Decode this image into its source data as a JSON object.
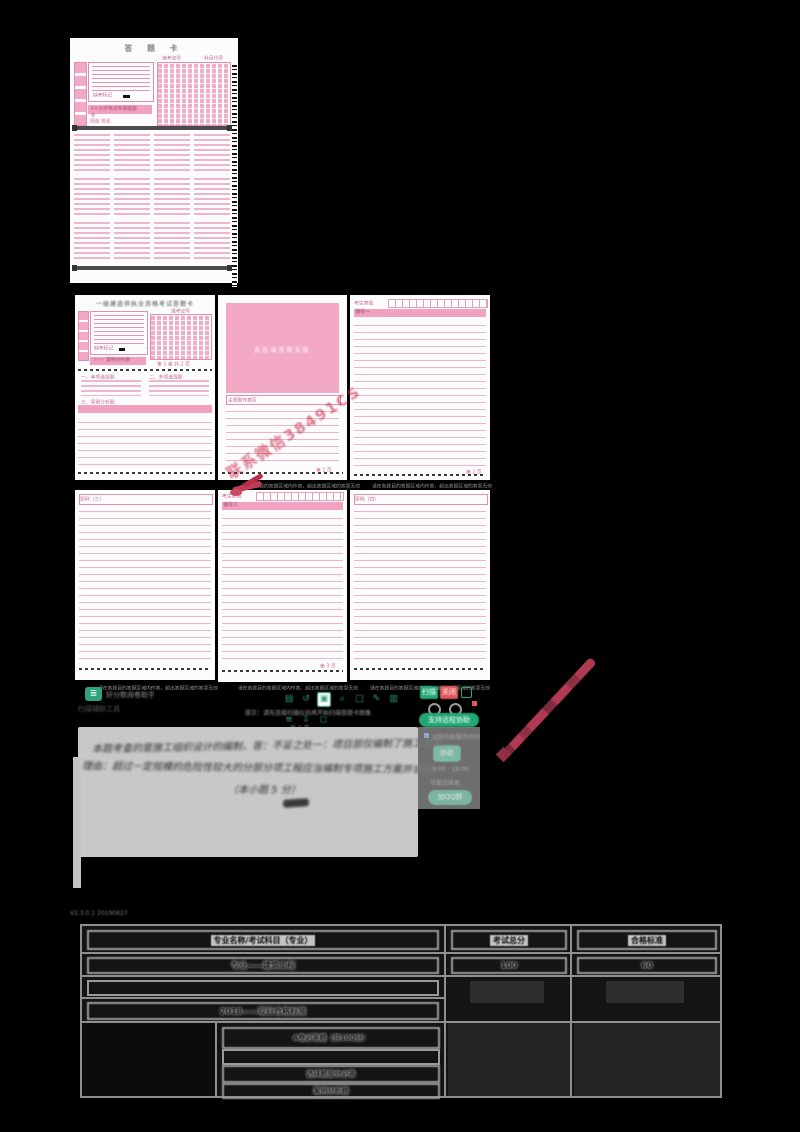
{
  "sheet1": {
    "title": "答  题  卡",
    "id_header": "准考证号",
    "subject_header": "科目代号",
    "absent_label": "缺考标记",
    "banner": "××大学考试专用答题卡",
    "class_row": "班级        姓名"
  },
  "sheet2": {
    "title": "一级建造师执业资格考试答题卡",
    "id_header": "准考证号",
    "vol_label": "第 1 卷  共 2 页",
    "sec1": "一、单项选择题",
    "sec2": "二、多项选择题",
    "sec3": "三、案例分析题",
    "banner": "（一）案例分析题",
    "absent_label": "缺考标记"
  },
  "pink_block_text": "此区域答题无效",
  "watermark_text": "联系微信38491CS",
  "panelB": {
    "header": "主观题作答区",
    "page": "第 1 页"
  },
  "panelC": {
    "header": "考生禁填",
    "band": "题号一",
    "page": "第 2 页"
  },
  "panelD": {
    "label": "案例（三）"
  },
  "panelE": {
    "header": "考生禁填",
    "band": "题号三",
    "page": "第 3 页"
  },
  "panelF": {
    "label": "案例（四）"
  },
  "tear_note": "请在各题目的答题区域内作答，超出答题区域的答案无效",
  "app": {
    "logo_glyph": "≣",
    "logo_text": "好分数阅卷助手",
    "sub_text": "扫描辅助工具",
    "tooltip": "提示：请先连接扫描仪后再开始扫描答题卡图像",
    "pages_text": "共 1 页",
    "toolbar_icons": [
      "▤",
      "↺",
      "▣",
      "⌕",
      "□",
      "✎",
      "▥",
      "≡",
      "⇩",
      "◻"
    ],
    "btn_scan": "扫描",
    "btn_stop": "关闭",
    "pill_remote": "支持远程协助",
    "btn_small": "协助",
    "note1": "远程协助服务时间",
    "note2": "9:00 - 18:00",
    "note3": "节假日休息",
    "pill_qq": "加QQ群",
    "status_text": "V2.3.0.1  20190627"
  },
  "handwriting": {
    "line1": "本题考查的是施工组织设计的编制，答：不妥之处一：项目部仅编制了施工方案；",
    "line2": "理由：超过一定规模的危险性较大的分部分项工程应当编制专项施工方案并论证。",
    "line3": "（本小题 5 分）"
  },
  "table": {
    "headers": [
      "专业名称/考试科目（专业）",
      "考试总分",
      "合格标准"
    ],
    "row1": {
      "c1": "专业——建筑工程",
      "c2": "100",
      "c3": "60"
    },
    "row2_label": "2018——现行合格标准",
    "sub_rows": [
      "A卷必答题（共100分）",
      "",
      "选择题部分必答",
      "案例分析题"
    ]
  }
}
